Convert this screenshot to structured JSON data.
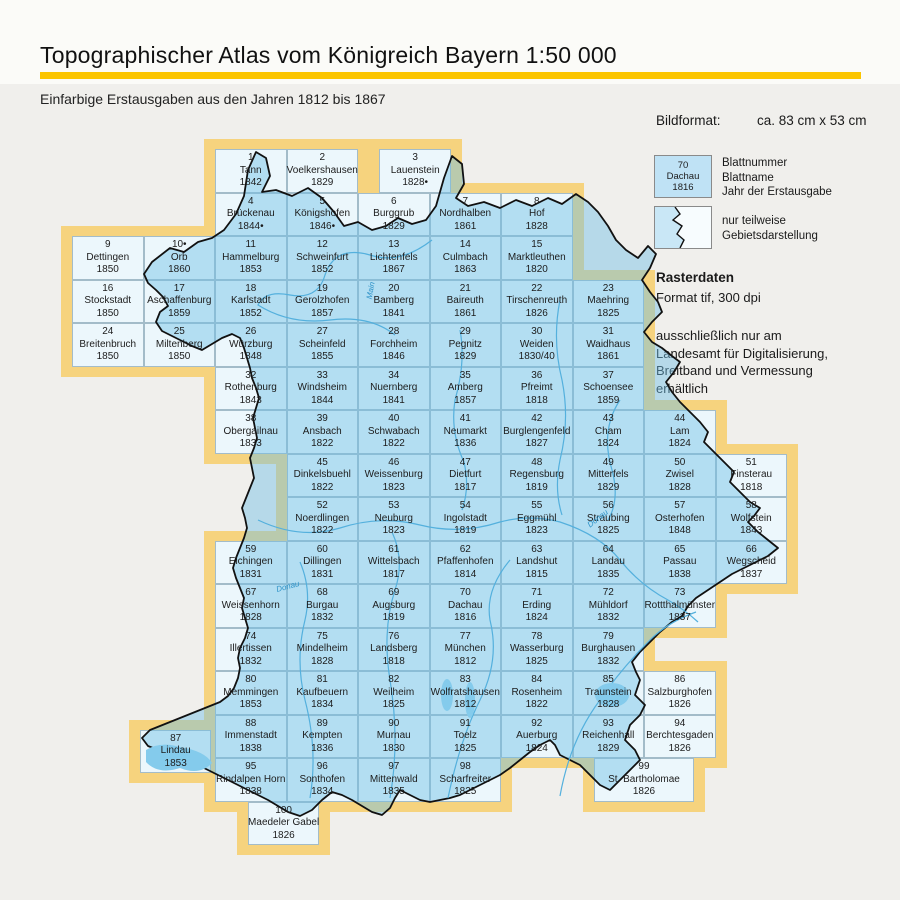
{
  "header": {
    "title": "Topographischer Atlas vom Königreich Bayern 1:50 000",
    "subtitle": "Einfarbige Erstausgaben aus den Jahren 1812 bis 1867",
    "rule_color": "#fbc500"
  },
  "info": {
    "bildformat_label": "Bildformat:",
    "bildformat_value": "ca. 83 cm x 53 cm",
    "legend_sample": {
      "num": "70",
      "name": "Dachau",
      "year": "1816"
    },
    "legend_sample_labels": [
      "Blattnummer",
      "Blattname",
      "Jahr der Erstausgabe"
    ],
    "legend_partial_labels": [
      "nur teilweise",
      "Gebietsdarstellung"
    ],
    "raster": {
      "title": "Rasterdaten",
      "format_line": "Format tif, 300 dpi",
      "note": [
        "ausschließlich nur am",
        "Landesamt für Digitalisierung,",
        "Breitband und Vermessung",
        "erhältlich"
      ]
    }
  },
  "map": {
    "colors": {
      "border_yellow": "#f6d37e",
      "cell_pale": "#ecf7fc",
      "cell_full": "#c9e6f5",
      "grid_line": "#a3bcc9",
      "outline_black": "#111111",
      "river_blue": "#54b0dd",
      "lake_blue": "#84cbec"
    },
    "river_labels": [
      {
        "text": "Main",
        "x": 362,
        "y": 286,
        "rot": -80
      },
      {
        "text": "Donau",
        "x": 586,
        "y": 514,
        "rot": -38
      },
      {
        "text": "Donau",
        "x": 276,
        "y": 582,
        "rot": -15
      }
    ],
    "cells": [
      {
        "n": "1",
        "name": "Tann",
        "year": "1842",
        "col": 3,
        "row": 1
      },
      {
        "n": "2",
        "name": "Voelkershausen",
        "year": "1829",
        "col": 4,
        "row": 1
      },
      {
        "n": "3",
        "name": "Lauenstein",
        "year": "1828•",
        "col": 5.3,
        "row": 1
      },
      {
        "n": "4",
        "name": "Brückenau",
        "year": "1844•",
        "col": 3,
        "row": 2
      },
      {
        "n": "5",
        "name": "Königshofen",
        "year": "1846•",
        "col": 4,
        "row": 2
      },
      {
        "n": "6",
        "name": "Burggrub",
        "year": "1829",
        "col": 5,
        "row": 2
      },
      {
        "n": "7",
        "name": "Nordhalben",
        "year": "1861",
        "col": 6,
        "row": 2
      },
      {
        "n": "8",
        "name": "Hof",
        "year": "1828",
        "col": 7,
        "row": 2
      },
      {
        "n": "9",
        "name": "Dettingen",
        "year": "1850",
        "col": 1,
        "row": 3
      },
      {
        "n": "10•",
        "name": "Orb",
        "year": "1860",
        "col": 2,
        "row": 3
      },
      {
        "n": "11",
        "name": "Hammelburg",
        "year": "1853",
        "col": 3,
        "row": 3
      },
      {
        "n": "12",
        "name": "Schweinfurt",
        "year": "1852",
        "col": 4,
        "row": 3
      },
      {
        "n": "13",
        "name": "Lichtenfels",
        "year": "1867",
        "col": 5,
        "row": 3
      },
      {
        "n": "14",
        "name": "Culmbach",
        "year": "1863",
        "col": 6,
        "row": 3
      },
      {
        "n": "15",
        "name": "Marktleuthen",
        "year": "1820",
        "col": 7,
        "row": 3
      },
      {
        "n": "16",
        "name": "Stockstadt",
        "year": "1850",
        "col": 1,
        "row": 4
      },
      {
        "n": "17",
        "name": "Aschaffenburg",
        "year": "1859",
        "col": 2,
        "row": 4
      },
      {
        "n": "18",
        "name": "Karlstadt",
        "year": "1852",
        "col": 3,
        "row": 4
      },
      {
        "n": "19",
        "name": "Gerolzhofen",
        "year": "1857",
        "col": 4,
        "row": 4
      },
      {
        "n": "20",
        "name": "Bamberg",
        "year": "1841",
        "col": 5,
        "row": 4
      },
      {
        "n": "21",
        "name": "Baireuth",
        "year": "1861",
        "col": 6,
        "row": 4
      },
      {
        "n": "22",
        "name": "Tirschenreuth",
        "year": "1826",
        "col": 7,
        "row": 4
      },
      {
        "n": "23",
        "name": "Maehring",
        "year": "1825",
        "col": 8,
        "row": 4
      },
      {
        "n": "24",
        "name": "Breitenbruch",
        "year": "1850",
        "col": 1,
        "row": 5
      },
      {
        "n": "25",
        "name": "Miltenberg",
        "year": "1850",
        "col": 2,
        "row": 5
      },
      {
        "n": "26",
        "name": "Würzburg",
        "year": "1848",
        "col": 3,
        "row": 5
      },
      {
        "n": "27",
        "name": "Scheinfeld",
        "year": "1855",
        "col": 4,
        "row": 5
      },
      {
        "n": "28",
        "name": "Forchheim",
        "year": "1846",
        "col": 5,
        "row": 5
      },
      {
        "n": "29",
        "name": "Pegnitz",
        "year": "1829",
        "col": 6,
        "row": 5
      },
      {
        "n": "30",
        "name": "Weiden",
        "year": "1830/40",
        "col": 7,
        "row": 5
      },
      {
        "n": "31",
        "name": "Waidhaus",
        "year": "1861",
        "col": 8,
        "row": 5
      },
      {
        "n": "32",
        "name": "Rothenburg",
        "year": "1843",
        "col": 3,
        "row": 6
      },
      {
        "n": "33",
        "name": "Windsheim",
        "year": "1844",
        "col": 4,
        "row": 6
      },
      {
        "n": "34",
        "name": "Nuernberg",
        "year": "1841",
        "col": 5,
        "row": 6
      },
      {
        "n": "35",
        "name": "Amberg",
        "year": "1857",
        "col": 6,
        "row": 6
      },
      {
        "n": "36",
        "name": "Pfreimt",
        "year": "1818",
        "col": 7,
        "row": 6
      },
      {
        "n": "37",
        "name": "Schoensee",
        "year": "1859",
        "col": 8,
        "row": 6
      },
      {
        "n": "38",
        "name": "Obergailnau",
        "year": "1833",
        "col": 3,
        "row": 7
      },
      {
        "n": "39",
        "name": "Ansbach",
        "year": "1822",
        "col": 4,
        "row": 7
      },
      {
        "n": "40",
        "name": "Schwabach",
        "year": "1822",
        "col": 5,
        "row": 7
      },
      {
        "n": "41",
        "name": "Neumarkt",
        "year": "1836",
        "col": 6,
        "row": 7
      },
      {
        "n": "42",
        "name": "Burglengenfeld",
        "year": "1827",
        "col": 7,
        "row": 7
      },
      {
        "n": "43",
        "name": "Cham",
        "year": "1824",
        "col": 8,
        "row": 7
      },
      {
        "n": "44",
        "name": "Lam",
        "year": "1824",
        "col": 9,
        "row": 7
      },
      {
        "n": "45",
        "name": "Dinkelsbuehl",
        "year": "1822",
        "col": 4,
        "row": 8
      },
      {
        "n": "46",
        "name": "Weissenburg",
        "year": "1823",
        "col": 5,
        "row": 8
      },
      {
        "n": "47",
        "name": "Dietfurt",
        "year": "1817",
        "col": 6,
        "row": 8
      },
      {
        "n": "48",
        "name": "Regensburg",
        "year": "1819",
        "col": 7,
        "row": 8
      },
      {
        "n": "49",
        "name": "Mitterfels",
        "year": "1829",
        "col": 8,
        "row": 8
      },
      {
        "n": "50",
        "name": "Zwisel",
        "year": "1828",
        "col": 9,
        "row": 8
      },
      {
        "n": "51",
        "name": "Finsterau",
        "year": "1818",
        "col": 10,
        "row": 8
      },
      {
        "n": "52",
        "name": "Noerdlingen",
        "year": "1822",
        "col": 4,
        "row": 9
      },
      {
        "n": "53",
        "name": "Neuburg",
        "year": "1823",
        "col": 5,
        "row": 9
      },
      {
        "n": "54",
        "name": "Ingolstadt",
        "year": "1819",
        "col": 6,
        "row": 9
      },
      {
        "n": "55",
        "name": "Eggmühl",
        "year": "1823",
        "col": 7,
        "row": 9
      },
      {
        "n": "56",
        "name": "Straubing",
        "year": "1825",
        "col": 8,
        "row": 9
      },
      {
        "n": "57",
        "name": "Osterhofen",
        "year": "1848",
        "col": 9,
        "row": 9
      },
      {
        "n": "58",
        "name": "Wolfstein",
        "year": "1843",
        "col": 10,
        "row": 9
      },
      {
        "n": "59",
        "name": "Elchingen",
        "year": "1831",
        "col": 3,
        "row": 10
      },
      {
        "n": "60",
        "name": "Dillingen",
        "year": "1831",
        "col": 4,
        "row": 10
      },
      {
        "n": "61",
        "name": "Wittelsbach",
        "year": "1817",
        "col": 5,
        "row": 10
      },
      {
        "n": "62",
        "name": "Pfaffenhofen",
        "year": "1814",
        "col": 6,
        "row": 10
      },
      {
        "n": "63",
        "name": "Landshut",
        "year": "1815",
        "col": 7,
        "row": 10
      },
      {
        "n": "64",
        "name": "Landau",
        "year": "1835",
        "col": 8,
        "row": 10
      },
      {
        "n": "65",
        "name": "Passau",
        "year": "1838",
        "col": 9,
        "row": 10
      },
      {
        "n": "66",
        "name": "Wegscheid",
        "year": "1837",
        "col": 10,
        "row": 10
      },
      {
        "n": "67",
        "name": "Weissenhorn",
        "year": "1828",
        "col": 3,
        "row": 11
      },
      {
        "n": "68",
        "name": "Burgau",
        "year": "1832",
        "col": 4,
        "row": 11
      },
      {
        "n": "69",
        "name": "Augsburg",
        "year": "1819",
        "col": 5,
        "row": 11
      },
      {
        "n": "70",
        "name": "Dachau",
        "year": "1816",
        "col": 6,
        "row": 11
      },
      {
        "n": "71",
        "name": "Erding",
        "year": "1824",
        "col": 7,
        "row": 11
      },
      {
        "n": "72",
        "name": "Mühldorf",
        "year": "1832",
        "col": 8,
        "row": 11
      },
      {
        "n": "73",
        "name": "Rottthalmünster",
        "year": "1837",
        "col": 9,
        "row": 11
      },
      {
        "n": "74",
        "name": "Illertissen",
        "year": "1832",
        "col": 3,
        "row": 12
      },
      {
        "n": "75",
        "name": "Mindelheim",
        "year": "1828",
        "col": 4,
        "row": 12
      },
      {
        "n": "76",
        "name": "Landsberg",
        "year": "1818",
        "col": 5,
        "row": 12
      },
      {
        "n": "77",
        "name": "München",
        "year": "1812",
        "col": 6,
        "row": 12
      },
      {
        "n": "78",
        "name": "Wasserburg",
        "year": "1825",
        "col": 7,
        "row": 12
      },
      {
        "n": "79",
        "name": "Burghausen",
        "year": "1832",
        "col": 8,
        "row": 12
      },
      {
        "n": "80",
        "name": "Memmingen",
        "year": "1853",
        "col": 3,
        "row": 13
      },
      {
        "n": "81",
        "name": "Kaufbeuern",
        "year": "1834",
        "col": 4,
        "row": 13
      },
      {
        "n": "82",
        "name": "Weilheim",
        "year": "1825",
        "col": 5,
        "row": 13
      },
      {
        "n": "83",
        "name": "Wolfratshausen",
        "year": "1812",
        "col": 6,
        "row": 13
      },
      {
        "n": "84",
        "name": "Rosenheim",
        "year": "1822",
        "col": 7,
        "row": 13
      },
      {
        "n": "85",
        "name": "Traunstein",
        "year": "1828",
        "col": 8,
        "row": 13
      },
      {
        "n": "86",
        "name": "Salzburghofen",
        "year": "1826",
        "col": 9,
        "row": 13
      },
      {
        "n": "87",
        "name": "Lindau",
        "year": "1853",
        "col": 1.95,
        "row": 14.35
      },
      {
        "n": "88",
        "name": "Immenstadt",
        "year": "1838",
        "col": 3,
        "row": 14
      },
      {
        "n": "89",
        "name": "Kempten",
        "year": "1836",
        "col": 4,
        "row": 14
      },
      {
        "n": "90",
        "name": "Murnau",
        "year": "1830",
        "col": 5,
        "row": 14
      },
      {
        "n": "91",
        "name": "Toelz",
        "year": "1825",
        "col": 6,
        "row": 14
      },
      {
        "n": "92",
        "name": "Auerburg",
        "year": "1824",
        "col": 7,
        "row": 14
      },
      {
        "n": "93",
        "name": "Reichenhall",
        "year": "1829",
        "col": 8,
        "row": 14
      },
      {
        "n": "94",
        "name": "Berchtesgaden",
        "year": "1826",
        "col": 9,
        "row": 14
      },
      {
        "n": "95",
        "name": "Rindalpen Horn",
        "year": "1838",
        "col": 3,
        "row": 15
      },
      {
        "n": "96",
        "name": "Sonthofen",
        "year": "1834",
        "col": 4,
        "row": 15
      },
      {
        "n": "97",
        "name": "Mittenwald",
        "year": "1835",
        "col": 5,
        "row": 15
      },
      {
        "n": "98",
        "name": "Scharfreiter",
        "year": "1825",
        "col": 6,
        "row": 15
      },
      {
        "n": "99",
        "name": "St. Bartholomae",
        "year": "1826",
        "col": 8.3,
        "row": 15,
        "w": 1.4
      },
      {
        "n": "100",
        "name": "Maedeler Gabel",
        "year": "1826",
        "col": 3.46,
        "row": 16
      }
    ]
  }
}
